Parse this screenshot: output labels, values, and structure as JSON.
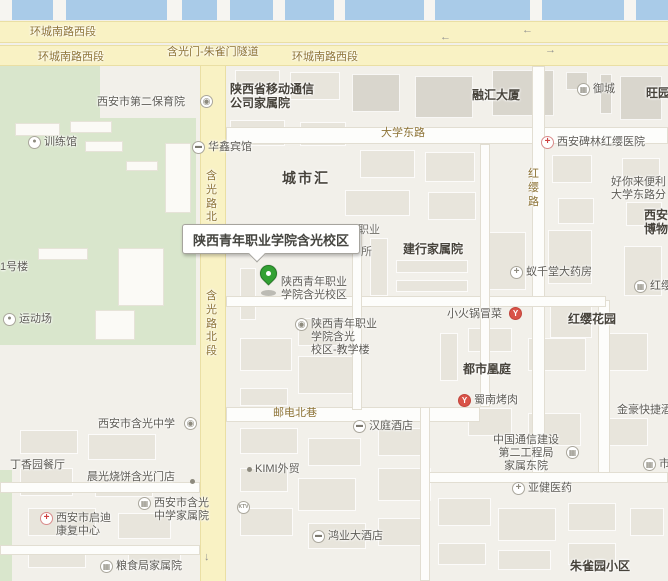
{
  "map": {
    "callout": {
      "text": "陕西青年职业学院含光校区"
    },
    "colors": {
      "water": "#a9cbe8",
      "road_yellow": "#f9f2c4",
      "green_area": "#d9e6cc",
      "pin_green": "#33a133",
      "hospital_red": "#cf4141",
      "restaurant_red": "#d95348"
    },
    "labels": [
      {
        "name": "road-label-huancheng-1",
        "text": "环城南路西段",
        "type": "road",
        "x": 30,
        "y": 26,
        "inter": false
      },
      {
        "name": "road-label-huancheng-2",
        "text": "环城南路西段",
        "type": "road",
        "x": 38,
        "y": 51,
        "inter": false
      },
      {
        "name": "road-label-tunnel",
        "text": "含光门-朱雀门隧道",
        "type": "road",
        "x": 167,
        "y": 46,
        "inter": false
      },
      {
        "name": "road-label-huancheng-3",
        "text": "环城南路西段",
        "type": "road",
        "x": 292,
        "y": 51,
        "inter": false
      },
      {
        "name": "lane-arrow-left-1",
        "text": "←",
        "type": "arrow",
        "x": 440,
        "y": 31,
        "inter": false
      },
      {
        "name": "lane-arrow-left-2",
        "text": "←",
        "type": "arrow",
        "x": 522,
        "y": 24,
        "inter": false
      },
      {
        "name": "lane-arrow-right",
        "text": "→",
        "type": "arrow",
        "x": 545,
        "y": 44,
        "inter": false
      },
      {
        "name": "lane-arrow-down",
        "text": "↓",
        "type": "arrow",
        "x": 204,
        "y": 551,
        "inter": false
      },
      {
        "name": "area-label-shaanxi-mobile-compound",
        "lines": [
          "陕西省移动通信",
          "公司家属院"
        ],
        "type": "area",
        "x": 230,
        "y": 82
      },
      {
        "name": "poi-label-second-nursery",
        "text": "西安市第二保育院",
        "type": "poi",
        "x": 97,
        "y": 96
      },
      {
        "name": "icon-second-nursery",
        "type": "icononly",
        "icon": "school",
        "x": 200,
        "y": 95
      },
      {
        "name": "area-label-ronghui-tower",
        "text": "融汇大厦",
        "type": "area",
        "x": 472,
        "y": 88
      },
      {
        "name": "poi-label-yucheng",
        "text": "御城",
        "type": "poi",
        "icon": "building",
        "x": 577,
        "y": 83
      },
      {
        "name": "area-label-wangyuan",
        "text": "旺园",
        "type": "area",
        "x": 646,
        "y": 86
      },
      {
        "name": "poi-label-training-hall",
        "text": "训练馆",
        "type": "poi",
        "icon": "sport",
        "x": 28,
        "y": 136
      },
      {
        "name": "poi-label-huaxin-hotel",
        "text": "华鑫宾馆",
        "type": "poi",
        "icon": "hotel",
        "x": 192,
        "y": 141
      },
      {
        "name": "area-label-chengshihui",
        "text": "城市汇",
        "type": "area",
        "cls": "big",
        "x": 282,
        "y": 170
      },
      {
        "name": "road-label-hanguang-north",
        "text": "含光路北",
        "type": "roadv",
        "x": 206,
        "y": 170,
        "inter": false
      },
      {
        "name": "road-label-daxue-east",
        "text": "大学东路",
        "type": "road",
        "x": 381,
        "y": 127,
        "inter": false
      },
      {
        "name": "poi-label-hongying-hospital",
        "text": "西安碑林红缨医院",
        "type": "poi",
        "icon": "hospital",
        "x": 541,
        "y": 136
      },
      {
        "name": "road-label-hongying",
        "text": "红缨路",
        "type": "roadv",
        "x": 528,
        "y": 168,
        "inter": false
      },
      {
        "name": "poi-label-haonilai-store",
        "lines": [
          "好你来便利",
          "大学东路分"
        ],
        "type": "poi",
        "x": 611,
        "y": 176
      },
      {
        "name": "area-label-xian-museum",
        "lines": [
          "西安",
          "博物"
        ],
        "type": "area",
        "x": 644,
        "y": 208
      },
      {
        "name": "partial-label-zhiye",
        "text": "职业",
        "type": "partial",
        "x": 358,
        "y": 224,
        "inter": false
      },
      {
        "name": "partial-label-suo",
        "text": "所",
        "type": "partial",
        "x": 361,
        "y": 246,
        "inter": false
      },
      {
        "name": "area-label-jianhang-compound",
        "text": "建行家属院",
        "type": "area",
        "x": 403,
        "y": 242
      },
      {
        "name": "poi-label-pin-text",
        "lines": [
          "陕西青年职业",
          "学院含光校区"
        ],
        "type": "poi",
        "x": 281,
        "y": 276
      },
      {
        "name": "poi-label-yiqiantang-pharmacy",
        "text": "蚁千堂大药房",
        "type": "poi",
        "icon": "pharmacy",
        "x": 510,
        "y": 266
      },
      {
        "name": "poi-label-hongying-partial",
        "text": "红缨",
        "type": "poi",
        "icon": "building",
        "x": 634,
        "y": 280
      },
      {
        "name": "poi-label-xiaohuoguo-maocai",
        "text": "小火锅冒菜",
        "type": "poi",
        "x": 447,
        "y": 308
      },
      {
        "name": "icon-xiaohuoguo",
        "type": "icononly",
        "icon": "restaurant",
        "x": 509,
        "y": 307
      },
      {
        "name": "area-label-hongying-garden",
        "text": "红缨花园",
        "type": "area",
        "x": 568,
        "y": 312
      },
      {
        "name": "poi-label-teaching-building",
        "lines": [
          "陕西青年职业",
          "学院含光",
          "校区-教学楼"
        ],
        "type": "poi",
        "icon": "school",
        "x": 295,
        "y": 318
      },
      {
        "name": "poi-label-sports-field",
        "text": "运动场",
        "type": "poi",
        "icon": "sport",
        "x": 3,
        "y": 313
      },
      {
        "name": "poi-label-building-1",
        "text": "1号楼",
        "type": "poi",
        "x": 0,
        "y": 261
      },
      {
        "name": "road-label-hanguang-north-section",
        "text": "含光路北段",
        "type": "roadv",
        "x": 206,
        "y": 290,
        "inter": false
      },
      {
        "name": "area-label-dushi-huangting",
        "text": "都市凰庭",
        "type": "area",
        "x": 463,
        "y": 362
      },
      {
        "name": "poi-label-shunan-bbq",
        "text": "蜀南烤肉",
        "type": "poi",
        "icon": "restaurant",
        "x": 458,
        "y": 394
      },
      {
        "name": "poi-label-jinhao-express-hotel",
        "text": "金豪快捷酒店",
        "type": "poi",
        "x": 617,
        "y": 404
      },
      {
        "name": "road-label-youdian-north-lane",
        "text": "邮电北巷",
        "type": "road",
        "x": 273,
        "y": 407,
        "inter": false
      },
      {
        "name": "poi-label-hanting-hotel",
        "text": "汉庭酒店",
        "type": "poi",
        "icon": "hotel",
        "x": 353,
        "y": 420
      },
      {
        "name": "poi-label-hanguang-middle-school",
        "text": "西安市含光中学",
        "type": "poi",
        "x": 98,
        "y": 418
      },
      {
        "name": "icon-hanguang-middle-school",
        "type": "icononly",
        "icon": "school",
        "x": 184,
        "y": 417
      },
      {
        "name": "poi-label-dingxiangyuan-restaurant",
        "text": "丁香园餐厅",
        "type": "poi",
        "x": 10,
        "y": 459
      },
      {
        "name": "poi-label-chenguang-shaobing",
        "text": "晨光烧饼含光门店",
        "type": "poi",
        "x": 87,
        "y": 471
      },
      {
        "name": "icon-chenguang-dot",
        "type": "icononly",
        "icon": "dot",
        "x": 190,
        "y": 475,
        "inter": false
      },
      {
        "name": "poi-label-kimi-trade",
        "text": "KIMI外贸",
        "type": "poi",
        "icon": "dot",
        "x": 247,
        "y": 463
      },
      {
        "name": "poi-label-comm-construction-compound",
        "lines": [
          "中国通信建设",
          "第二工程局",
          "家属东院"
        ],
        "type": "poi",
        "align": "center",
        "x": 493,
        "y": 434
      },
      {
        "name": "icon-comm-construction",
        "type": "icononly",
        "icon": "building",
        "x": 566,
        "y": 446
      },
      {
        "name": "poi-label-yajian-pharmacy",
        "text": "亚健医药",
        "type": "poi",
        "icon": "pharmacy",
        "x": 512,
        "y": 482
      },
      {
        "name": "poi-label-qidi-rehab-center",
        "lines": [
          "西安市启迪",
          "康复中心"
        ],
        "type": "poi",
        "icon": "hospital",
        "x": 40,
        "y": 512
      },
      {
        "name": "poi-label-hanguang-school-compound",
        "lines": [
          "西安市含光",
          "中学家属院"
        ],
        "type": "poi",
        "icon": "building",
        "x": 138,
        "y": 497
      },
      {
        "name": "poi-label-liangshiju-compound",
        "text": "粮食局家属院",
        "type": "poi",
        "icon": "building",
        "x": 100,
        "y": 560
      },
      {
        "name": "icon-ktv",
        "type": "icononly",
        "icon": "ktv",
        "x": 237,
        "y": 501
      },
      {
        "name": "poi-label-hongye-hotel",
        "text": "鸿业大酒店",
        "type": "poi",
        "icon": "hotel",
        "x": 312,
        "y": 530
      },
      {
        "name": "poi-label-right-edge-partial",
        "text": "市",
        "type": "poi",
        "icon": "building",
        "x": 643,
        "y": 458
      },
      {
        "name": "area-label-zhuqueyuan",
        "text": "朱雀园小区",
        "type": "area",
        "x": 570,
        "y": 559
      }
    ]
  }
}
